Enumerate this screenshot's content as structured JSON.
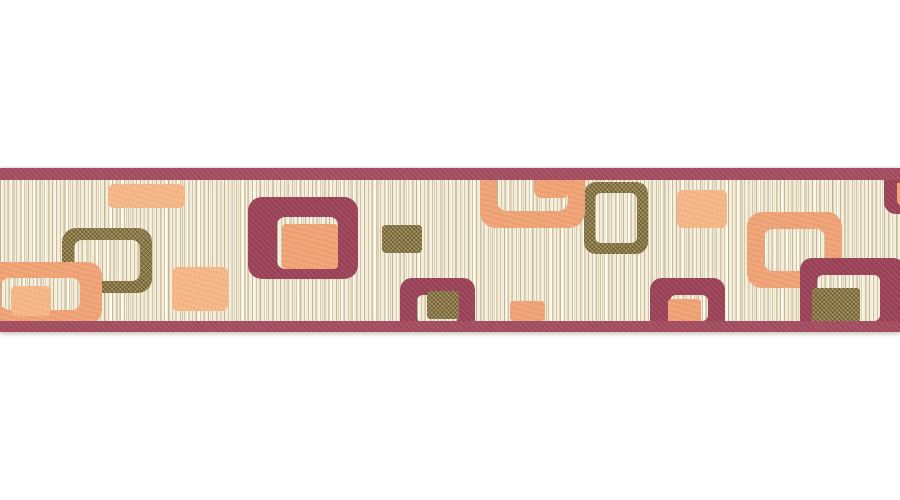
{
  "canvas": {
    "width": 900,
    "height": 500,
    "background_color": "#ffffff"
  },
  "palette": {
    "cream": "#f3edd9",
    "maroon_band": "#a54c60",
    "maroon": "#9c4157",
    "orange": "#efa173",
    "orange_light": "#f5b685",
    "olive": "#8c7a4a"
  },
  "strip": {
    "x": 0,
    "y": 168,
    "width": 900,
    "height": 164,
    "field_color": "cream"
  },
  "shapes": [
    {
      "name": "olive-frame-left",
      "kind": "frame",
      "x": 62,
      "y": 228,
      "w": 90,
      "h": 65,
      "bw": [
        12,
        12,
        12,
        12
      ],
      "r": 14,
      "color": "olive",
      "z": 5
    },
    {
      "name": "olive-frame-center",
      "kind": "frame",
      "x": 584,
      "y": 182,
      "w": 64,
      "h": 72,
      "bw": [
        11,
        11,
        11,
        11
      ],
      "r": 12,
      "color": "olive",
      "z": 5
    },
    {
      "name": "maroon-frame-left",
      "kind": "frame",
      "x": 248,
      "y": 197,
      "w": 110,
      "h": 82,
      "bw": [
        20,
        20,
        10,
        29
      ],
      "r": 14,
      "color": "maroon",
      "z": 8
    },
    {
      "name": "orange-frame-left",
      "kind": "frame",
      "x": -14,
      "y": 262,
      "w": 116,
      "h": 62,
      "bw": [
        16,
        22,
        14,
        15
      ],
      "r": 14,
      "color": "orange",
      "z": 10
    },
    {
      "name": "orange-inner-rect-left",
      "kind": "rect",
      "x": 11,
      "y": 286,
      "w": 40,
      "h": 30,
      "r": 5,
      "color": "orange_light",
      "z": 11
    },
    {
      "name": "orange-rect-top-left",
      "kind": "rect",
      "x": 108,
      "y": 184,
      "w": 77,
      "h": 24,
      "r": 6,
      "color": "orange_light",
      "z": 10
    },
    {
      "name": "orange-rect-mid-left",
      "kind": "rect",
      "x": 172,
      "y": 267,
      "w": 56,
      "h": 44,
      "r": 6,
      "color": "orange_light",
      "z": 10
    },
    {
      "name": "orange-rect-in-maroon-frame",
      "kind": "rect",
      "x": 282,
      "y": 224,
      "w": 56,
      "h": 45,
      "r": 4,
      "color": "orange",
      "z": 10
    },
    {
      "name": "olive-rect-center-top",
      "kind": "rect",
      "x": 382,
      "y": 225,
      "w": 40,
      "h": 28,
      "r": 4,
      "color": "olive",
      "z": 12
    },
    {
      "name": "maroon-frame-bottom-center",
      "kind": "frame",
      "x": 400,
      "y": 278,
      "w": 75,
      "h": 62,
      "bw": [
        17,
        17,
        17,
        17
      ],
      "r": 12,
      "color": "maroon",
      "z": 20
    },
    {
      "name": "olive-rect-in-bottom-frame",
      "kind": "rect",
      "x": 427,
      "y": 291,
      "w": 32,
      "h": 28,
      "r": 3,
      "color": "olive",
      "z": 22
    },
    {
      "name": "orange-frame-top-center",
      "kind": "frame",
      "x": 480,
      "y": 140,
      "w": 105,
      "h": 88,
      "bw": [
        17,
        17,
        17,
        17
      ],
      "r": 16,
      "color": "orange",
      "z": 10
    },
    {
      "name": "orange-tab-top-center",
      "kind": "rect",
      "x": 534,
      "y": 170,
      "w": 36,
      "h": 28,
      "r": "0 0 8px 8px",
      "color": "orange",
      "z": 12
    },
    {
      "name": "orange-rect-bottom-center",
      "kind": "rect",
      "x": 510,
      "y": 301,
      "w": 35,
      "h": 20,
      "r": 4,
      "color": "orange",
      "z": 10
    },
    {
      "name": "orange-rect-top-right",
      "kind": "rect",
      "x": 677,
      "y": 190,
      "w": 50,
      "h": 38,
      "r": 6,
      "color": "orange_light",
      "z": 10
    },
    {
      "name": "maroon-frame-bottom-right-small",
      "kind": "frame",
      "x": 650,
      "y": 278,
      "w": 75,
      "h": 60,
      "bw": [
        17,
        17,
        17,
        20
      ],
      "r": 12,
      "color": "maroon",
      "z": 20
    },
    {
      "name": "orange-rect-in-small-frame",
      "kind": "rect",
      "x": 668,
      "y": 299,
      "w": 33,
      "h": 25,
      "r": 3,
      "color": "orange",
      "z": 22
    },
    {
      "name": "orange-frame-right",
      "kind": "frame",
      "x": 747,
      "y": 212,
      "w": 95,
      "h": 76,
      "bw": [
        17,
        17,
        17,
        17
      ],
      "r": 15,
      "color": "orange",
      "z": 10
    },
    {
      "name": "maroon-frame-far-right",
      "kind": "frame",
      "x": 800,
      "y": 258,
      "w": 105,
      "h": 80,
      "bw": [
        17,
        25,
        17,
        17
      ],
      "r": 12,
      "color": "maroon",
      "z": 20
    },
    {
      "name": "olive-rect-in-far-right-frame",
      "kind": "rect",
      "x": 812,
      "y": 288,
      "w": 48,
      "h": 34,
      "r": 3,
      "color": "olive",
      "z": 22
    },
    {
      "name": "maroon-corner-top-right",
      "kind": "rect",
      "x": 884,
      "y": 168,
      "w": 26,
      "h": 46,
      "r": "0 0 0 12px",
      "color": "maroon",
      "z": 20
    },
    {
      "name": "orange-corner-top-right",
      "kind": "rect",
      "x": 897,
      "y": 183,
      "w": 13,
      "h": 23,
      "r": "0 0 0 6px",
      "color": "orange",
      "z": 21
    },
    {
      "name": "top-band",
      "kind": "rect",
      "x": 0,
      "y": 168,
      "w": 900,
      "h": 12,
      "r": 0,
      "color": "maroon_band",
      "z": 50
    },
    {
      "name": "bottom-band",
      "kind": "rect",
      "x": 0,
      "y": 321,
      "w": 900,
      "h": 11,
      "r": 0,
      "color": "maroon_band",
      "z": 50
    }
  ]
}
